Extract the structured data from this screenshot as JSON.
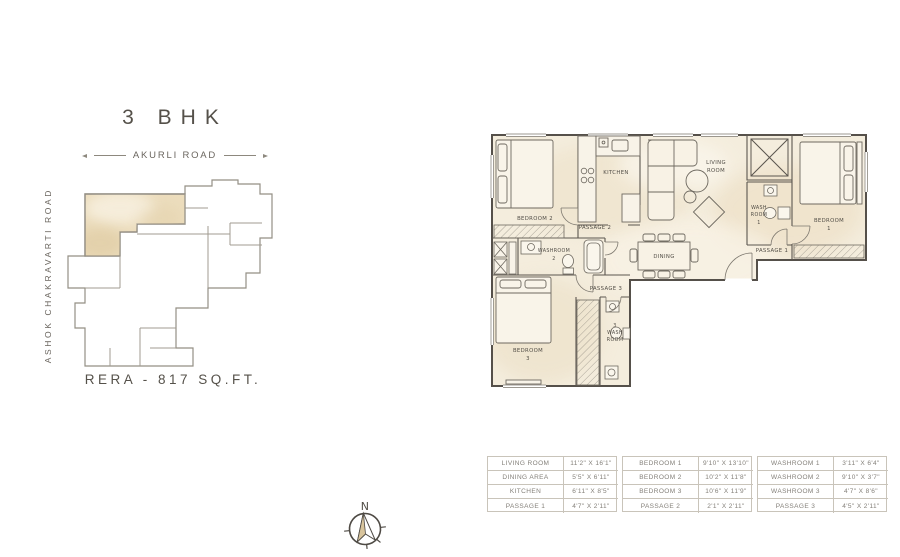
{
  "title": "3 BHK",
  "rera_text": "RERA - 817 SQ.FT.",
  "roads": {
    "top": "AKURLI ROAD",
    "left": "ASHOK CHAKRAVARTI ROAD"
  },
  "compass": {
    "north": "N"
  },
  "colors": {
    "plan_fill": "#f3ecdc",
    "highlight_fill": "#e9d9b8",
    "wall": "#56514a",
    "table_border": "#c9c4ba",
    "muted_text": "#84807a"
  },
  "plan": {
    "labels": {
      "bedroom2": "BEDROOM 2",
      "kitchen": "KITCHEN",
      "living1": "LIVING",
      "living2": "ROOM",
      "wash1a": "WASH",
      "wash1b": "ROOM",
      "wash1n": "1",
      "bedroom1a": "BEDROOM",
      "bedroom1n": "1",
      "passage2": "PASSAGE 2",
      "washroom2a": "WASHROOM",
      "washroom2n": "2",
      "dining": "DINING",
      "passage1": "PASSAGE 1",
      "passage3": "PASSAGE 3",
      "bedroom3a": "BEDROOM",
      "bedroom3n": "3",
      "wash3n": "3",
      "wash3a": "WASH",
      "wash3b": "ROOM"
    }
  },
  "tables": [
    {
      "rows": [
        {
          "name": "LIVING ROOM",
          "dim": "11'2\" X 16'1\""
        },
        {
          "name": "DINING AREA",
          "dim": "5'5\" X 6'11\""
        },
        {
          "name": "KITCHEN",
          "dim": "6'11\" X 8'5\""
        },
        {
          "name": "PASSAGE 1",
          "dim": "4'7\" X 2'11\""
        }
      ]
    },
    {
      "rows": [
        {
          "name": "BEDROOM 1",
          "dim": "9'10\" X 13'10\""
        },
        {
          "name": "BEDROOM 2",
          "dim": "10'2\" X 11'8\""
        },
        {
          "name": "BEDROOM 3",
          "dim": "10'6\" X 11'9\""
        },
        {
          "name": "PASSAGE 2",
          "dim": "2'1\" X 2'11\""
        }
      ]
    },
    {
      "rows": [
        {
          "name": "WASHROOM 1",
          "dim": "3'11\" X 6'4\""
        },
        {
          "name": "WASHROOM 2",
          "dim": "9'10\" X 3'7\""
        },
        {
          "name": "WASHROOM 3",
          "dim": "4'7\" X 8'6\""
        },
        {
          "name": "PASSAGE 3",
          "dim": "4'5\" X 2'11\""
        }
      ]
    }
  ]
}
